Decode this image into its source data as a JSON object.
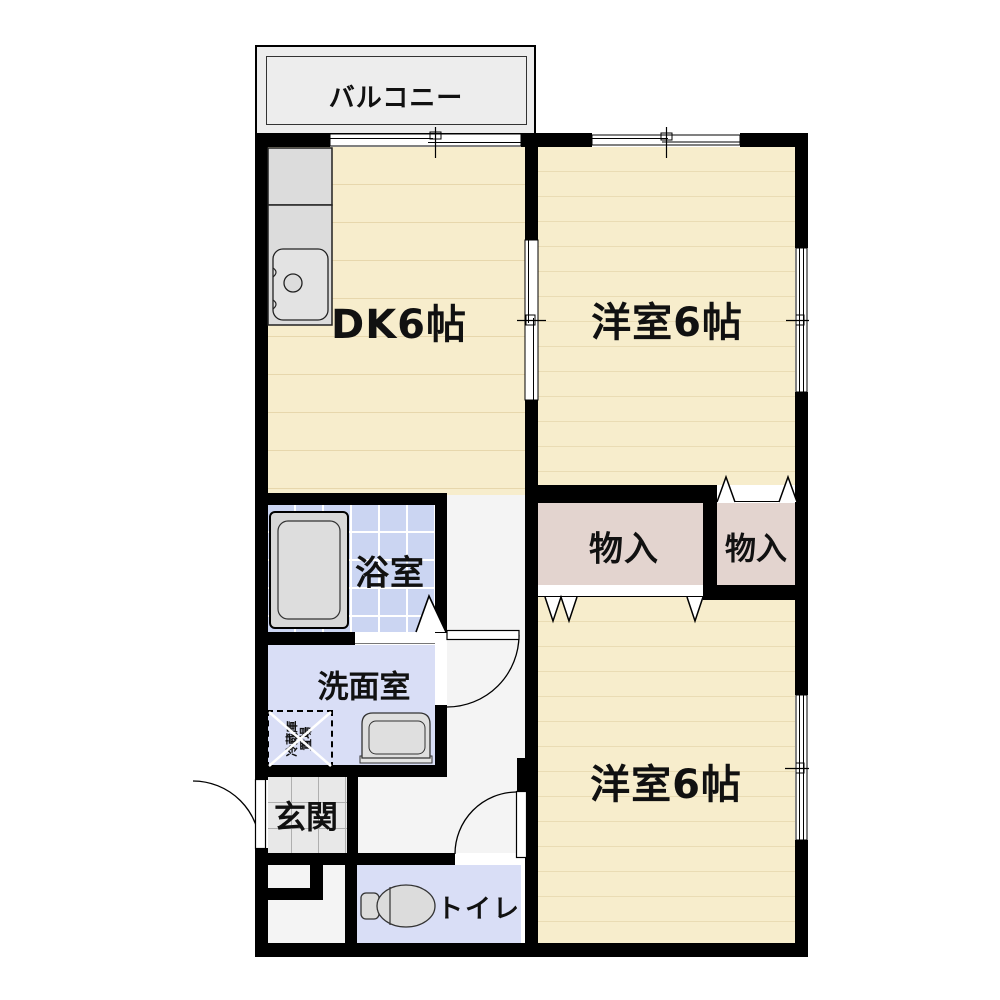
{
  "title": "2DK apartment floor plan",
  "labels": {
    "balcony": "バルコニー",
    "dk": "DK6帖",
    "bedroom_top": "洋室6帖",
    "bedroom_bottom": "洋室6帖",
    "storage_left": "物入",
    "storage_right": "物入",
    "bathroom": "浴室",
    "washroom": "洗面室",
    "entrance": "玄関",
    "toilet": "トイレ",
    "fridge_line1": "冷蔵庫",
    "fridge_line2": "置場"
  },
  "rooms": [
    {
      "name": "バルコニー",
      "type": "balcony"
    },
    {
      "name": "DK6帖",
      "type": "dining-kitchen",
      "size_jo": 6
    },
    {
      "name": "洋室6帖",
      "type": "western-room",
      "size_jo": 6,
      "position": "top-right"
    },
    {
      "name": "洋室6帖",
      "type": "western-room",
      "size_jo": 6,
      "position": "bottom-right"
    },
    {
      "name": "物入",
      "type": "closet",
      "position": "center-left"
    },
    {
      "name": "物入",
      "type": "closet",
      "position": "center-right"
    },
    {
      "name": "浴室",
      "type": "bathroom"
    },
    {
      "name": "洗面室",
      "type": "washroom"
    },
    {
      "name": "玄関",
      "type": "entrance"
    },
    {
      "name": "トイレ",
      "type": "toilet"
    },
    {
      "name": "冷蔵庫置場",
      "type": "refrigerator-space"
    }
  ],
  "colors": {
    "wall": "#000000",
    "wood_floor": "#F7EDCC",
    "wood_line": "#E7D7AC",
    "closet": "#E3D4CF",
    "bath_tile": "#CBD5F2",
    "wet_floor": "#D9DEF6",
    "hall_floor": "#F4F4F4",
    "entrance_tile": "#E8E8E8",
    "balcony": "#EDEDED",
    "fixture_gray": "#DCDCDC"
  }
}
